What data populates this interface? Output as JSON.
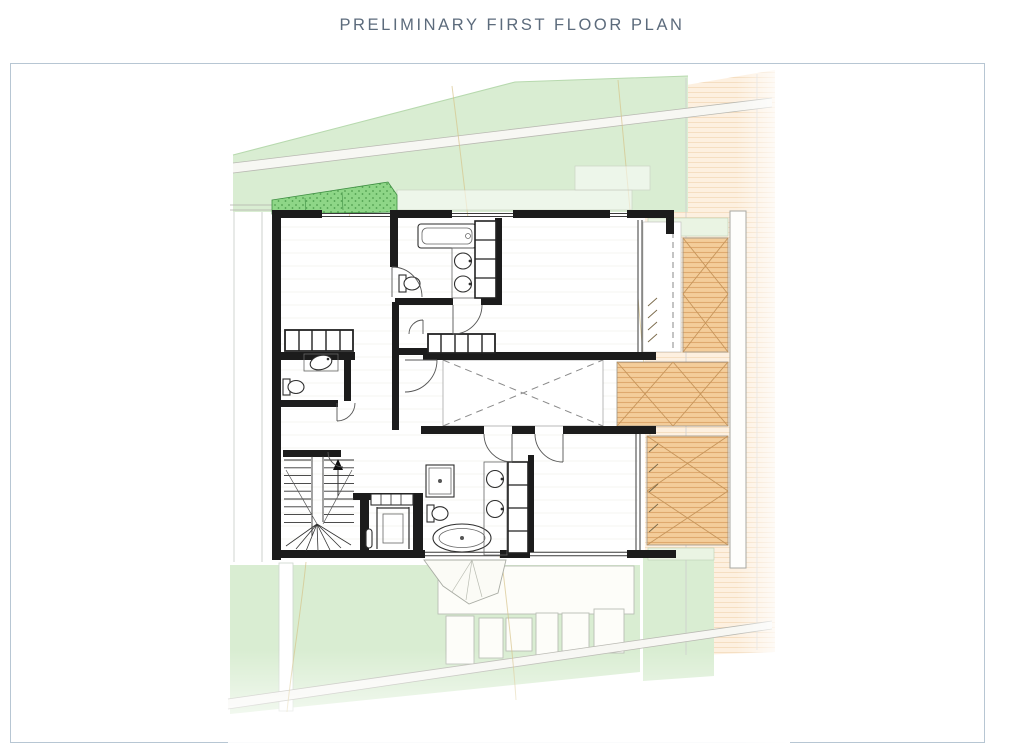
{
  "title": "PRELIMINARY FIRST FLOOR PLAN",
  "colors": {
    "frame_border": "#b7c6d3",
    "title_text": "#5c6b7c",
    "wall": "#1c1c1c",
    "lawn": "#d9edd2",
    "lawn_line": "#b7d9ae",
    "planter": "#8ed687",
    "planter_dot": "#4f9e4f",
    "deck": "#f4cd9a",
    "deck_line": "#dfa96e",
    "deck_cross": "#c6955b",
    "neighbor": "#fdf0e0",
    "neighbor_line": "#f5dec1",
    "thin_line": "#8f9499",
    "faint_line": "#c6cbc6",
    "contour": "#d5c185",
    "fixture_line": "#2e2e2e",
    "road_fill": "#f7f7f3",
    "road_edge": "#b9b9b2"
  },
  "plan_symbols": [
    "bathtub",
    "freestanding-bathtub",
    "double-vanity-sinks",
    "toilet",
    "shower",
    "wardrobe-row",
    "shelving-column",
    "staircase-up-arrow",
    "lift-platform",
    "void-opening-dashed-x",
    "timber-deck-cross-braced",
    "planter-strip",
    "lawn-area",
    "site-road",
    "privacy-screen",
    "neighbor-lot-hatch"
  ]
}
